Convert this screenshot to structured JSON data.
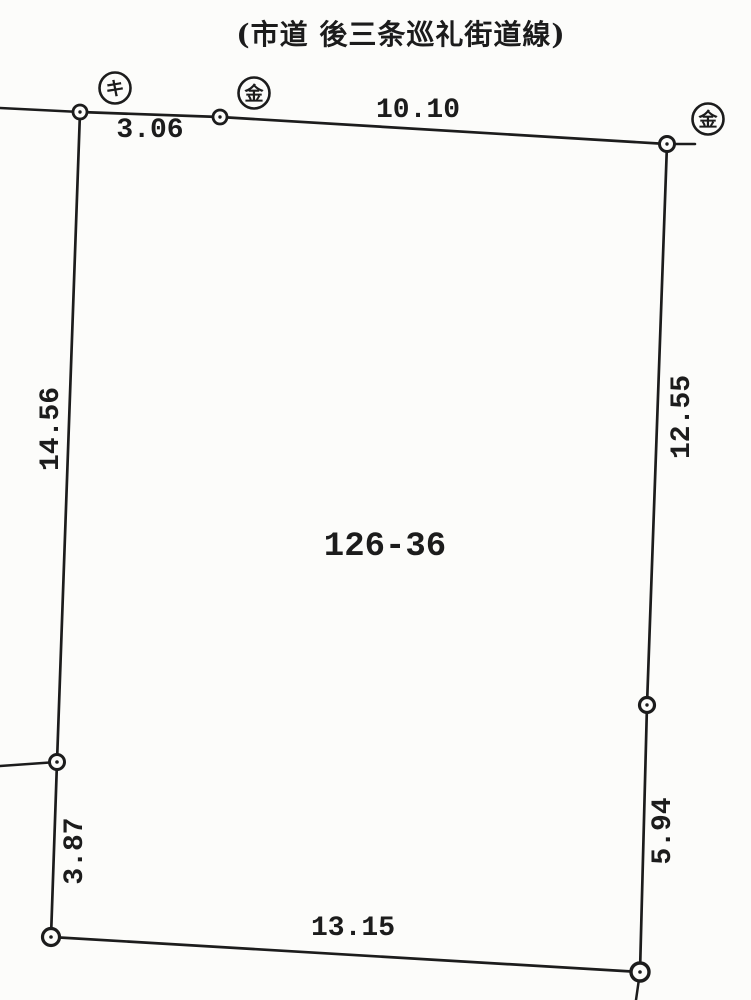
{
  "road_name_label": "(市道 後三条巡礼街道線)",
  "parcel": {
    "number": "126-36"
  },
  "dimensions": {
    "top_west": "3.06",
    "top_east": "10.10",
    "west_upper": "14.56",
    "west_lower": "3.87",
    "east_upper": "12.55",
    "east_lower": "5.94",
    "south": "13.15"
  },
  "survey_markers": {
    "ki": "キ",
    "kin_top": "金",
    "kin_east": "金"
  },
  "colors": {
    "ink": "#1c1c1c",
    "paper": "#fcfcfa"
  }
}
